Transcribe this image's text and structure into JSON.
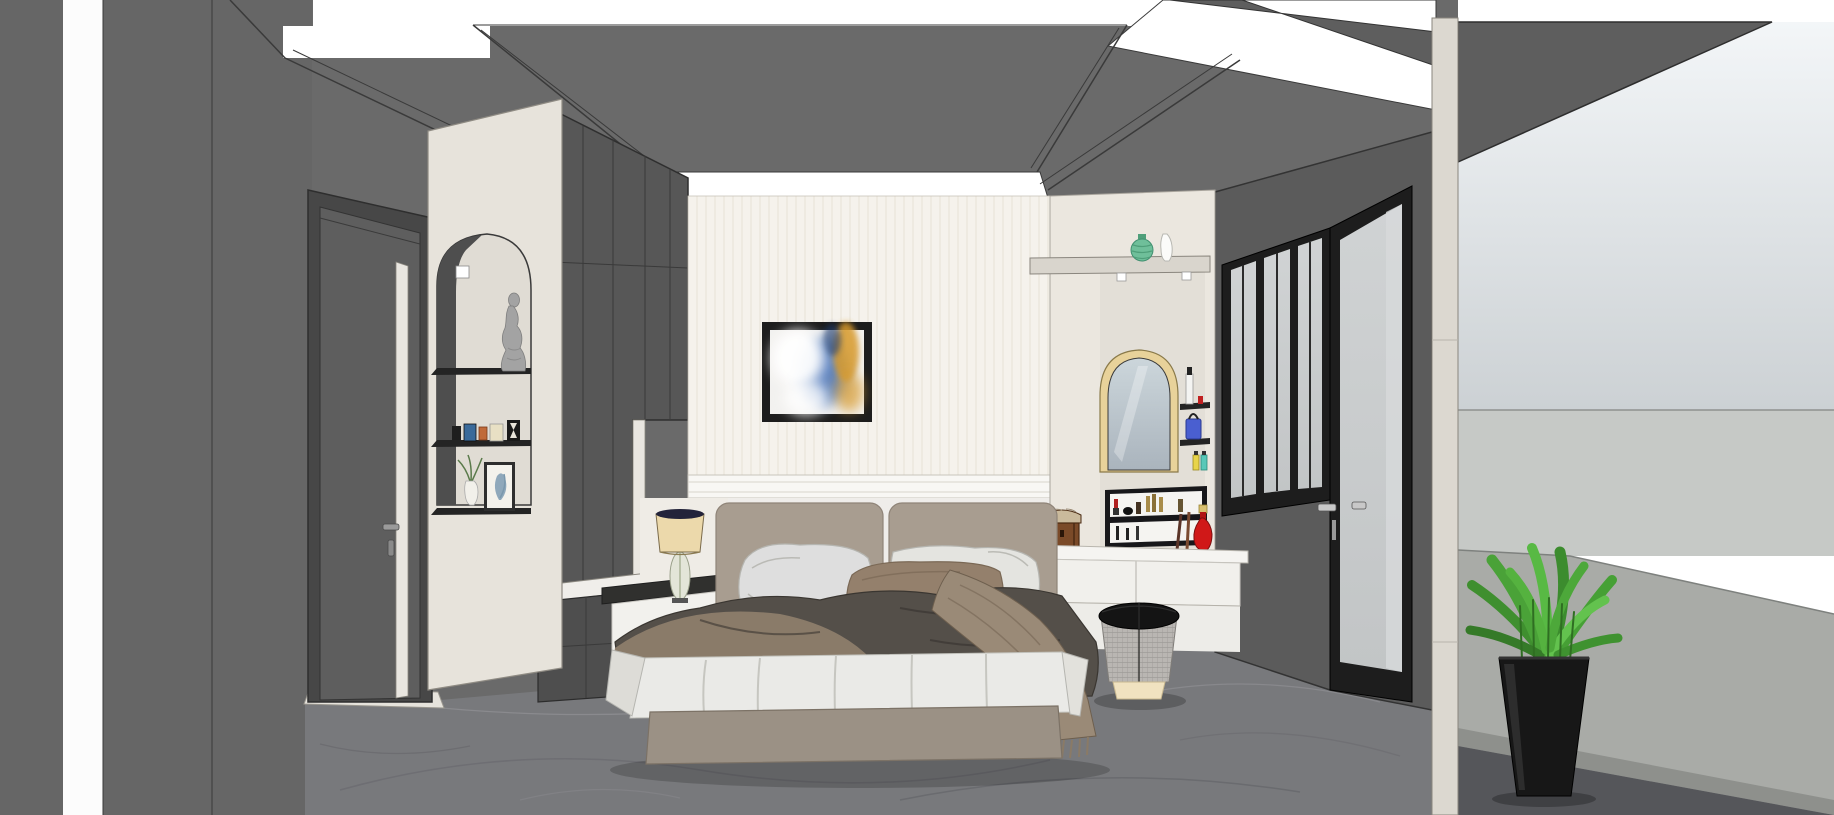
{
  "scene": {
    "description": "Modern bedroom interior 3D render, one-point perspective, no UI chrome",
    "room_type": "bedroom",
    "objects": [
      {
        "id": "ceiling",
        "label": "Dark coffered ceiling with recessed white LED light panels"
      },
      {
        "id": "cove-light",
        "label": "Recessed white cove light above headboard wall"
      },
      {
        "id": "left-wall",
        "label": "Dark gray side wall with vertical white light slot"
      },
      {
        "id": "interior-door",
        "label": "Gray interior door with cream inlay stripe and lever handle"
      },
      {
        "id": "niche-column",
        "label": "Cream column with arched display niche"
      },
      {
        "id": "statue",
        "label": "Classical stone statue figurine on niche shelf"
      },
      {
        "id": "mini-frames",
        "label": "Row of small framed photos and hourglass on niche shelf"
      },
      {
        "id": "botanical-art",
        "label": "Framed botanical print and bud vase on niche shelf"
      },
      {
        "id": "wardrobe",
        "label": "Floor-to-ceiling dark gray paneled wardrobe with lower drawers"
      },
      {
        "id": "wallpaper-wall",
        "label": "Cream striped wallpaper headboard wall with molding"
      },
      {
        "id": "abstract-art",
        "label": "Black-framed abstract cloud artwork above bed"
      },
      {
        "id": "headboard",
        "label": "Two-panel taupe upholstered headboard"
      },
      {
        "id": "bed",
        "label": "Double bed with white pillows, brown accent pillow, charcoal duvet, tan fringed throw, white sheet"
      },
      {
        "id": "nightstand",
        "label": "Floating nightstand with dark top and white drawer"
      },
      {
        "id": "table-lamp",
        "label": "Table lamp, tan drum shade with dark rim, glass leaf base"
      },
      {
        "id": "vanity-column",
        "label": "Cream vanity alcove"
      },
      {
        "id": "display-shelf",
        "label": "High shelf with green ribbed vase and white vase, two downlights"
      },
      {
        "id": "vanity-mirror",
        "label": "Arched vanity mirror with gold frame"
      },
      {
        "id": "cosmetic-shelves",
        "label": "Two mini black wall shelves with cosmetics"
      },
      {
        "id": "makeup-organizer",
        "label": "Black open display box with lipsticks and makeup"
      },
      {
        "id": "jewelry-chest",
        "label": "Small wooden jewelry chest"
      },
      {
        "id": "red-perfume",
        "label": "Red perfume bottle with gold cap"
      },
      {
        "id": "vanity-desk",
        "label": "Floating white vanity desk with two drawers"
      },
      {
        "id": "vanity-stool",
        "label": "Round stool: black top, woven gray body, cream base"
      },
      {
        "id": "window-wall",
        "label": "Dark gray wall with black aluminum three-pane window"
      },
      {
        "id": "glass-door",
        "label": "Full-height black-framed glass balcony door with handles"
      },
      {
        "id": "balcony",
        "label": "Balcony beyond: sky, light parapet wall, gray floor"
      },
      {
        "id": "potted-plant",
        "label": "Green leafy plant in black tapered planter"
      },
      {
        "id": "marble-floor",
        "label": "Gray marble tile floor with veining"
      }
    ]
  },
  "palette": {
    "wall_gray": "#6a6a6a",
    "left_wall_gray": "#666666",
    "wall_dark": "#5b5b5b",
    "soffit_gray": "#5e5e5e",
    "light_white": "#ffffff",
    "slot_white": "#fcfcfc",
    "cream_panel": "#ebe7df",
    "cream_column": "#e7e3db",
    "mirror_wall": "#e3dfd7",
    "wallpaper": "#f5f2ec",
    "wallpaper_stripe": "#e9e4da",
    "molding_white": "#f8f7f4",
    "lower_wall": "#efedea",
    "niche_inner": "#e0dcd4",
    "niche_shadow": "#4e4e4e",
    "shelf_black": "#242424",
    "wardrobe_gray": "#575757",
    "door_frame": "#474747",
    "door_gray": "#5e5e5e",
    "door_stripe": "#e9e6e0",
    "threshold": "#e6e3dc",
    "frame_black": "#1d1d1d",
    "glass_top": "#d0d3d4",
    "glass_bottom": "#c2c5c6",
    "corner_column": "#dcd8d0",
    "floor_marble": "#78797c",
    "headboard_taupe": "#a89d90",
    "pillow_white": "#dedede",
    "pillow_white2": "#e4e4e0",
    "pillow_brown": "#94806c",
    "duvet_charcoal": "#544f49",
    "duvet_brown": "#8d7d6c",
    "throw_tan": "#9a8a77",
    "sheet_white": "#eaeae7",
    "bed_base": "#9b9185",
    "nightstand_top": "#30302e",
    "nightstand_white": "#f2f1ed",
    "lamp_shade": "#ecd9ab",
    "lamp_rim": "#23233a",
    "lamp_glass": "#e3e5d8",
    "shelf_board": "#d9d5cd",
    "vase_green": "#6fbf9a",
    "vase_white": "#fbfbf9",
    "mirror_gold": "#e8d29a",
    "mirror_glass_top": "#ccd6db",
    "mirror_glass_bottom": "#aab4bd",
    "desk_white": "#f5f4f1",
    "drawer_white": "#f1f0ec",
    "cabinet_white": "#edece8",
    "organizer_black": "#17171a",
    "organizer_back": "#f5f4f1",
    "chest_brown": "#7a4a28",
    "chest_lid": "#caba9c",
    "perfume_red": "#d01818",
    "perfume_cap_gold": "#d8c070",
    "bag_blue": "#4a5fd0",
    "bottle_yellow": "#e8d44a",
    "bottle_teal": "#58c8b8",
    "stool_black": "#141414",
    "stool_fabric": "#b9b6b2",
    "stool_base": "#f0e2c0",
    "statue_gray": "#a3a3a3",
    "art_white": "#f2f1ef",
    "art_blue": "#3a6bb5",
    "art_navy": "#1e3a6e",
    "art_gold": "#d89a2b",
    "sky_top": "#f3f6f8",
    "sky_bottom": "#ccd1d4",
    "parapet_light": "#c6c9c6",
    "balcony_wall": "#a9aba7",
    "balcony_skirt": "#8e908c",
    "balcony_floor": "#55565a",
    "plant_green": "#4fa83a",
    "planter_black": "#171717"
  }
}
